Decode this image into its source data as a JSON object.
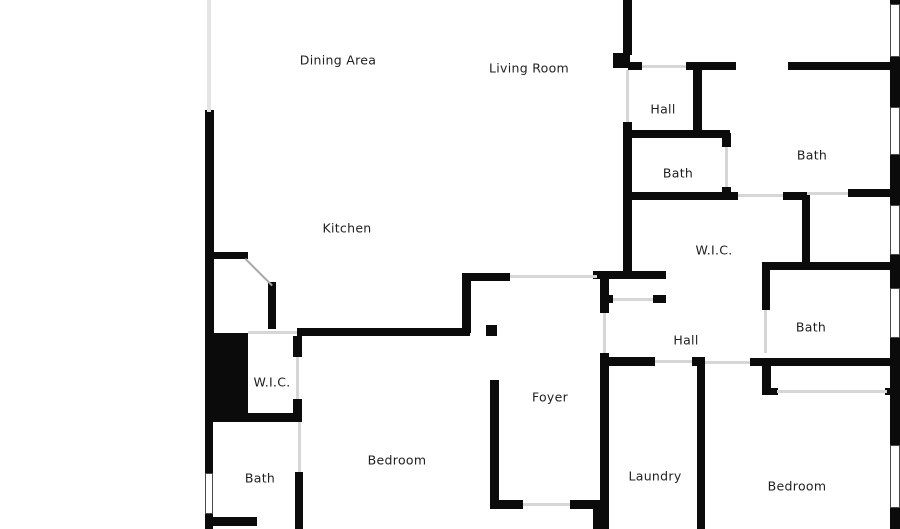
{
  "plan": {
    "width": 900,
    "height": 529,
    "colors": {
      "background": "#ffffff",
      "wall": "#0b0b0b",
      "opening": "#d6d6d6",
      "faint_wall": "#e4e4e4",
      "window_border": "#4a4a4a",
      "label": "#1f1f1f"
    }
  },
  "rooms": [
    {
      "label": "Dining Area",
      "x": 338,
      "y": 60
    },
    {
      "label": "Living Room",
      "x": 529,
      "y": 68
    },
    {
      "label": "Hall",
      "x": 663,
      "y": 109
    },
    {
      "label": "Bath",
      "x": 678,
      "y": 173
    },
    {
      "label": "Bath",
      "x": 812,
      "y": 155
    },
    {
      "label": "W.I.C.",
      "x": 714,
      "y": 250
    },
    {
      "label": "Kitchen",
      "x": 347,
      "y": 228
    },
    {
      "label": "Hall",
      "x": 686,
      "y": 340
    },
    {
      "label": "Bath",
      "x": 811,
      "y": 327
    },
    {
      "label": "W.I.C.",
      "x": 272,
      "y": 382
    },
    {
      "label": "Foyer",
      "x": 550,
      "y": 397
    },
    {
      "label": "Bath",
      "x": 260,
      "y": 478
    },
    {
      "label": "Bedroom",
      "x": 397,
      "y": 460
    },
    {
      "label": "Laundry",
      "x": 655,
      "y": 476
    },
    {
      "label": "Bedroom",
      "x": 797,
      "y": 486
    }
  ],
  "walls": [
    {
      "x": 205,
      "y": 110,
      "w": 9,
      "h": 223
    },
    {
      "x": 212,
      "y": 252,
      "w": 36,
      "h": 7
    },
    {
      "x": 268,
      "y": 282,
      "w": 8,
      "h": 47
    },
    {
      "x": 297,
      "y": 328,
      "w": 173,
      "h": 8
    },
    {
      "x": 486,
      "y": 325,
      "w": 11,
      "h": 11
    },
    {
      "x": 293,
      "y": 336,
      "w": 9,
      "h": 21
    },
    {
      "x": 293,
      "y": 399,
      "w": 9,
      "h": 15
    },
    {
      "x": 208,
      "y": 413,
      "w": 94,
      "h": 9
    },
    {
      "x": 205,
      "y": 413,
      "w": 8,
      "h": 62
    },
    {
      "x": 205,
      "y": 514,
      "w": 8,
      "h": 15
    },
    {
      "x": 213,
      "y": 517,
      "w": 44,
      "h": 9
    },
    {
      "x": 295,
      "y": 472,
      "w": 8,
      "h": 57
    },
    {
      "x": 462,
      "y": 273,
      "w": 9,
      "h": 60
    },
    {
      "x": 462,
      "y": 273,
      "w": 48,
      "h": 8
    },
    {
      "x": 490,
      "y": 380,
      "w": 9,
      "h": 125
    },
    {
      "x": 490,
      "y": 500,
      "w": 33,
      "h": 9
    },
    {
      "x": 570,
      "y": 500,
      "w": 33,
      "h": 9
    },
    {
      "x": 593,
      "y": 500,
      "w": 10,
      "h": 29
    },
    {
      "x": 600,
      "y": 273,
      "w": 9,
      "h": 40
    },
    {
      "x": 600,
      "y": 353,
      "w": 9,
      "h": 176
    },
    {
      "x": 593,
      "y": 271,
      "w": 73,
      "h": 8
    },
    {
      "x": 600,
      "y": 295,
      "w": 13,
      "h": 8
    },
    {
      "x": 653,
      "y": 295,
      "w": 13,
      "h": 8
    },
    {
      "x": 603,
      "y": 357,
      "w": 52,
      "h": 9
    },
    {
      "x": 692,
      "y": 357,
      "w": 13,
      "h": 9
    },
    {
      "x": 697,
      "y": 360,
      "w": 8,
      "h": 169
    },
    {
      "x": 750,
      "y": 358,
      "w": 140,
      "h": 8
    },
    {
      "x": 762,
      "y": 360,
      "w": 9,
      "h": 35
    },
    {
      "x": 762,
      "y": 388,
      "w": 16,
      "h": 7
    },
    {
      "x": 885,
      "y": 388,
      "w": 12,
      "h": 7
    },
    {
      "x": 623,
      "y": 0,
      "w": 9,
      "h": 55
    },
    {
      "x": 613,
      "y": 53,
      "w": 17,
      "h": 15
    },
    {
      "x": 628,
      "y": 62,
      "w": 14,
      "h": 8
    },
    {
      "x": 686,
      "y": 62,
      "w": 50,
      "h": 8
    },
    {
      "x": 788,
      "y": 62,
      "w": 102,
      "h": 8
    },
    {
      "x": 693,
      "y": 65,
      "w": 9,
      "h": 67
    },
    {
      "x": 628,
      "y": 130,
      "w": 102,
      "h": 8
    },
    {
      "x": 623,
      "y": 122,
      "w": 9,
      "h": 151
    },
    {
      "x": 722,
      "y": 133,
      "w": 9,
      "h": 14
    },
    {
      "x": 722,
      "y": 187,
      "w": 9,
      "h": 13
    },
    {
      "x": 628,
      "y": 192,
      "w": 110,
      "h": 8
    },
    {
      "x": 783,
      "y": 192,
      "w": 24,
      "h": 8
    },
    {
      "x": 802,
      "y": 192,
      "w": 8,
      "h": 70
    },
    {
      "x": 848,
      "y": 189,
      "w": 49,
      "h": 8
    },
    {
      "x": 762,
      "y": 262,
      "w": 138,
      "h": 8
    },
    {
      "x": 762,
      "y": 270,
      "w": 8,
      "h": 40
    },
    {
      "x": 890,
      "y": 0,
      "w": 10,
      "h": 4
    },
    {
      "x": 890,
      "y": 57,
      "w": 10,
      "h": 50
    },
    {
      "x": 890,
      "y": 155,
      "w": 10,
      "h": 50
    },
    {
      "x": 890,
      "y": 255,
      "w": 10,
      "h": 33
    },
    {
      "x": 890,
      "y": 338,
      "w": 10,
      "h": 107
    },
    {
      "x": 890,
      "y": 508,
      "w": 10,
      "h": 21
    }
  ],
  "solid_blocks": [
    {
      "x": 205,
      "y": 333,
      "w": 43,
      "h": 80
    }
  ],
  "windows": [
    {
      "x": 890,
      "y": 4,
      "w": 10,
      "h": 53
    },
    {
      "x": 890,
      "y": 107,
      "w": 10,
      "h": 48
    },
    {
      "x": 890,
      "y": 205,
      "w": 10,
      "h": 50
    },
    {
      "x": 890,
      "y": 288,
      "w": 10,
      "h": 50
    },
    {
      "x": 890,
      "y": 445,
      "w": 10,
      "h": 63
    },
    {
      "x": 205,
      "y": 473,
      "w": 8,
      "h": 41
    }
  ],
  "openings": [
    {
      "x": 510,
      "y": 275,
      "w": 87,
      "h": 3
    },
    {
      "x": 523,
      "y": 503,
      "w": 47,
      "h": 3
    },
    {
      "x": 613,
      "y": 298,
      "w": 40,
      "h": 3
    },
    {
      "x": 655,
      "y": 360,
      "w": 37,
      "h": 3
    },
    {
      "x": 705,
      "y": 361,
      "w": 45,
      "h": 3
    },
    {
      "x": 642,
      "y": 65,
      "w": 44,
      "h": 3
    },
    {
      "x": 738,
      "y": 194,
      "w": 45,
      "h": 3
    },
    {
      "x": 807,
      "y": 192,
      "w": 41,
      "h": 3
    },
    {
      "x": 764,
      "y": 310,
      "w": 3,
      "h": 43
    },
    {
      "x": 626,
      "y": 70,
      "w": 3,
      "h": 52
    },
    {
      "x": 725,
      "y": 147,
      "w": 3,
      "h": 40
    },
    {
      "x": 603,
      "y": 313,
      "w": 3,
      "h": 40
    },
    {
      "x": 296,
      "y": 357,
      "w": 3,
      "h": 42
    },
    {
      "x": 298,
      "y": 422,
      "w": 3,
      "h": 50
    },
    {
      "x": 248,
      "y": 331,
      "w": 49,
      "h": 3
    },
    {
      "x": 777,
      "y": 390,
      "w": 110,
      "h": 3
    }
  ],
  "faint_lines": [
    {
      "x": 207,
      "y": 0,
      "w": 4,
      "h": 112
    }
  ],
  "door_swings": [
    {
      "x": 246,
      "y": 258,
      "len": 38,
      "angle": 45
    }
  ]
}
